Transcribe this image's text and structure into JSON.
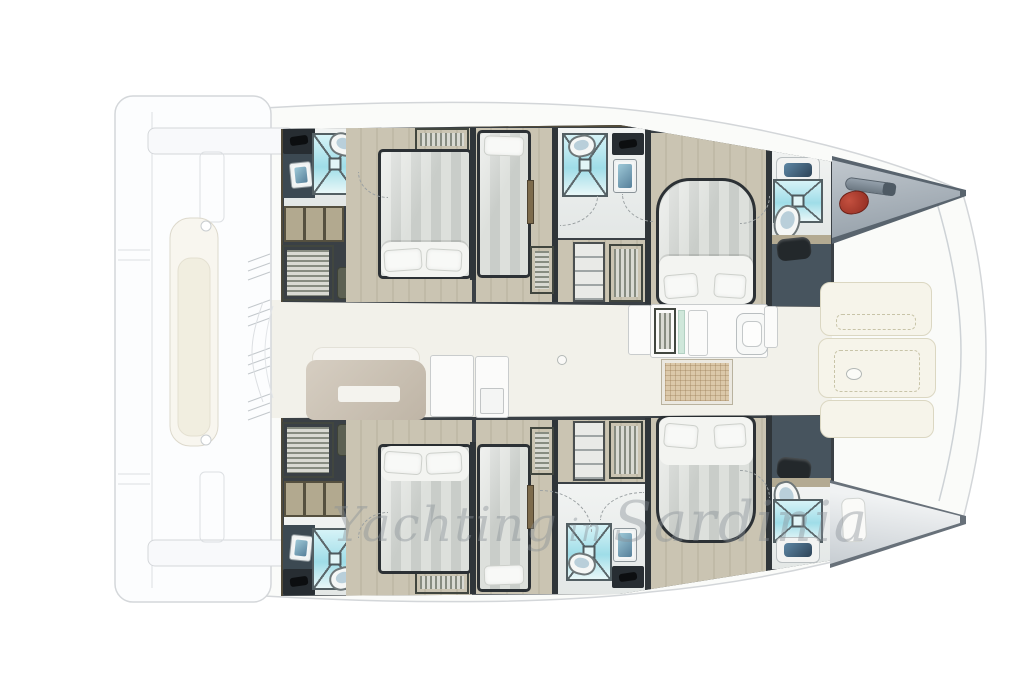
{
  "watermark": {
    "part1": "Yachting",
    "part2": "in",
    "part3": "Sardinia"
  },
  "palette": {
    "hull_wall": "#3a4045",
    "cabin_floor": "#c5bfad",
    "bathroom_floor": "#eceeec",
    "shower_teal": "#aee4ec",
    "bed_stripe": "#d4d7d3",
    "duvet_white": "#f3f4f1",
    "sofa_tan": "#cbc2b3",
    "sun_pad_cream": "#f6f4ea",
    "anchor_red": "#a93227",
    "locker_gray": "#9aa4ad",
    "ghost_deck_line": "#d4d7da"
  },
  "plan": {
    "vessel": "catamaran-floor-plan",
    "hull_top": {
      "fixtures": [
        {
          "t": "floor-bath",
          "x": 3,
          "y": 3,
          "w": 74,
          "h": 78
        },
        {
          "t": "vanity-dark",
          "x": 2,
          "y": 3,
          "w": 32,
          "h": 70
        },
        {
          "t": "counter-dark",
          "x": 2,
          "y": 3,
          "w": 32,
          "h": 26
        },
        {
          "t": "sink-blue",
          "x": 9,
          "y": 37,
          "w": 22,
          "h": 26,
          "r": -6
        },
        {
          "t": "shower",
          "x": 31,
          "y": 8,
          "w": 46,
          "h": 62
        },
        {
          "t": "toilet",
          "x": 48,
          "y": 8,
          "w": 29,
          "h": 23,
          "r": 18
        },
        {
          "t": "shelf-tan",
          "x": 3,
          "y": 81,
          "w": 60,
          "h": 36
        },
        {
          "t": "louver-h",
          "x": 1,
          "y": 120,
          "w": 52,
          "h": 56
        },
        {
          "t": "olive-box",
          "x": 56,
          "y": 142,
          "w": 40,
          "h": 32
        },
        {
          "t": "floor-cabin",
          "x": 65,
          "y": 3,
          "w": 126,
          "h": 174
        },
        {
          "t": "louver-v",
          "x": 134,
          "y": 3,
          "w": 54,
          "h": 23
        },
        {
          "t": "bed-double",
          "x": 97,
          "y": 24,
          "w": 94,
          "h": 130
        },
        {
          "t": "duvet",
          "x": 100,
          "y": 117,
          "w": 88,
          "h": 35
        },
        {
          "t": "pillow",
          "x": 103,
          "y": 124,
          "w": 38,
          "h": 22,
          "r": -4
        },
        {
          "t": "pillow",
          "x": 145,
          "y": 124,
          "w": 36,
          "h": 22,
          "r": 3
        },
        {
          "t": "wall",
          "x": 189,
          "y": 3,
          "w": 6,
          "h": 152
        },
        {
          "t": "floor-cabin",
          "x": 195,
          "y": 3,
          "w": 76,
          "h": 174
        },
        {
          "t": "bed-single",
          "x": 196,
          "y": 5,
          "w": 54,
          "h": 148
        },
        {
          "t": "pillow",
          "x": 203,
          "y": 11,
          "w": 40,
          "h": 20,
          "r": 2
        },
        {
          "t": "door-panel",
          "x": 246,
          "y": 55,
          "w": 7,
          "h": 44
        },
        {
          "t": "wall",
          "x": 271,
          "y": 3,
          "w": 6,
          "h": 174
        },
        {
          "t": "floor-bath",
          "x": 277,
          "y": 3,
          "w": 87,
          "h": 110
        },
        {
          "t": "shower",
          "x": 281,
          "y": 8,
          "w": 46,
          "h": 64
        },
        {
          "t": "toilet",
          "x": 287,
          "y": 10,
          "w": 28,
          "h": 22,
          "r": -12
        },
        {
          "t": "counter-dark",
          "x": 331,
          "y": 8,
          "w": 32,
          "h": 22
        },
        {
          "t": "sink-blue",
          "x": 332,
          "y": 34,
          "w": 24,
          "h": 34
        },
        {
          "t": "floor-cabin",
          "x": 277,
          "y": 115,
          "w": 87,
          "h": 62
        },
        {
          "t": "louver-h",
          "x": 249,
          "y": 121,
          "w": 24,
          "h": 48
        },
        {
          "t": "shelf-white",
          "x": 292,
          "y": 117,
          "w": 32,
          "h": 60
        },
        {
          "t": "louver-v",
          "x": 328,
          "y": 119,
          "w": 34,
          "h": 58
        },
        {
          "t": "wall",
          "x": 364,
          "y": 3,
          "w": 6,
          "h": 176
        },
        {
          "t": "floor-cabin",
          "x": 370,
          "y": 8,
          "w": 115,
          "h": 172
        },
        {
          "t": "bed-island-top",
          "x": 375,
          "y": 53,
          "w": 100,
          "h": 128
        },
        {
          "t": "duvet",
          "x": 378,
          "y": 131,
          "w": 94,
          "h": 48
        },
        {
          "t": "pillow",
          "x": 383,
          "y": 149,
          "w": 34,
          "h": 24,
          "r": -5
        },
        {
          "t": "pillow",
          "x": 433,
          "y": 149,
          "w": 32,
          "h": 24,
          "r": 4
        },
        {
          "t": "wall",
          "x": 485,
          "y": 3,
          "w": 6,
          "h": 178
        },
        {
          "t": "floor-bath",
          "x": 491,
          "y": 25,
          "w": 59,
          "h": 88
        },
        {
          "t": "counter-white",
          "x": 495,
          "y": 32,
          "w": 44,
          "h": 26
        },
        {
          "t": "shower",
          "x": 492,
          "y": 54,
          "w": 50,
          "h": 44
        },
        {
          "t": "toilet",
          "x": 493,
          "y": 80,
          "w": 26,
          "h": 34,
          "r": 15
        },
        {
          "t": "trim-tan",
          "x": 491,
          "y": 110,
          "w": 59,
          "h": 9
        },
        {
          "t": "slate",
          "x": 491,
          "y": 119,
          "w": 59,
          "h": 62
        },
        {
          "t": "bag",
          "x": 496,
          "y": 113,
          "w": 34,
          "h": 22,
          "r": -6
        }
      ]
    },
    "hull_bottom": {
      "fixtures": [
        {
          "t": "floor-bath",
          "x": 3,
          "y": 104,
          "w": 74,
          "h": 78
        },
        {
          "t": "vanity-dark",
          "x": 2,
          "y": 112,
          "w": 32,
          "h": 70
        },
        {
          "t": "counter-dark",
          "x": 2,
          "y": 156,
          "w": 32,
          "h": 26
        },
        {
          "t": "sink-blue",
          "x": 9,
          "y": 122,
          "w": 22,
          "h": 26,
          "r": 6
        },
        {
          "t": "shower",
          "x": 31,
          "y": 115,
          "w": 46,
          "h": 62
        },
        {
          "t": "toilet",
          "x": 48,
          "y": 154,
          "w": 29,
          "h": 23,
          "r": -18
        },
        {
          "t": "shelf-tan",
          "x": 3,
          "y": 68,
          "w": 60,
          "h": 36
        },
        {
          "t": "louver-h",
          "x": 1,
          "y": 9,
          "w": 52,
          "h": 56
        },
        {
          "t": "olive-box",
          "x": 56,
          "y": 11,
          "w": 40,
          "h": 32
        },
        {
          "t": "floor-cabin",
          "x": 65,
          "y": 7,
          "w": 126,
          "h": 176
        },
        {
          "t": "louver-v",
          "x": 134,
          "y": 158,
          "w": 54,
          "h": 23
        },
        {
          "t": "bed-double",
          "x": 97,
          "y": 31,
          "w": 94,
          "h": 130
        },
        {
          "t": "duvet",
          "x": 100,
          "y": 33,
          "w": 88,
          "h": 35
        },
        {
          "t": "pillow",
          "x": 103,
          "y": 39,
          "w": 38,
          "h": 22,
          "r": 4
        },
        {
          "t": "pillow",
          "x": 145,
          "y": 39,
          "w": 36,
          "h": 22,
          "r": -3
        },
        {
          "t": "wall",
          "x": 189,
          "y": 29,
          "w": 6,
          "h": 152
        },
        {
          "t": "floor-cabin",
          "x": 195,
          "y": 7,
          "w": 76,
          "h": 174
        },
        {
          "t": "bed-single",
          "x": 196,
          "y": 31,
          "w": 54,
          "h": 148
        },
        {
          "t": "pillow",
          "x": 203,
          "y": 152,
          "w": 40,
          "h": 20,
          "r": -2
        },
        {
          "t": "door-panel",
          "x": 246,
          "y": 72,
          "w": 7,
          "h": 44
        },
        {
          "t": "wall",
          "x": 271,
          "y": 7,
          "w": 6,
          "h": 174
        },
        {
          "t": "floor-bath",
          "x": 277,
          "y": 71,
          "w": 87,
          "h": 110
        },
        {
          "t": "shower",
          "x": 285,
          "y": 110,
          "w": 46,
          "h": 58
        },
        {
          "t": "toilet",
          "x": 287,
          "y": 140,
          "w": 28,
          "h": 22,
          "r": 12
        },
        {
          "t": "counter-dark",
          "x": 331,
          "y": 153,
          "w": 32,
          "h": 22
        },
        {
          "t": "sink-blue",
          "x": 332,
          "y": 115,
          "w": 24,
          "h": 34
        },
        {
          "t": "floor-cabin",
          "x": 277,
          "y": 7,
          "w": 87,
          "h": 62
        },
        {
          "t": "louver-h",
          "x": 249,
          "y": 14,
          "w": 24,
          "h": 48
        },
        {
          "t": "shelf-white",
          "x": 292,
          "y": 8,
          "w": 32,
          "h": 60
        },
        {
          "t": "louver-v",
          "x": 328,
          "y": 8,
          "w": 34,
          "h": 58
        },
        {
          "t": "wall",
          "x": 364,
          "y": 5,
          "w": 6,
          "h": 176
        },
        {
          "t": "floor-cabin",
          "x": 370,
          "y": 5,
          "w": 115,
          "h": 172
        },
        {
          "t": "bed-island-bottom",
          "x": 375,
          "y": 2,
          "w": 100,
          "h": 128
        },
        {
          "t": "duvet",
          "x": 378,
          "y": 4,
          "w": 94,
          "h": 48
        },
        {
          "t": "pillow",
          "x": 383,
          "y": 11,
          "w": 34,
          "h": 24,
          "r": 5
        },
        {
          "t": "pillow",
          "x": 433,
          "y": 11,
          "w": 32,
          "h": 24,
          "r": -4
        },
        {
          "t": "wall",
          "x": 485,
          "y": 2,
          "w": 6,
          "h": 178
        },
        {
          "t": "slate",
          "x": 491,
          "y": 3,
          "w": 59,
          "h": 62
        },
        {
          "t": "bag",
          "x": 496,
          "y": 45,
          "w": 34,
          "h": 22,
          "r": 6
        },
        {
          "t": "trim-tan",
          "x": 491,
          "y": 65,
          "w": 59,
          "h": 9
        },
        {
          "t": "floor-bath",
          "x": 491,
          "y": 74,
          "w": 59,
          "h": 82
        },
        {
          "t": "toilet",
          "x": 493,
          "y": 68,
          "w": 26,
          "h": 34,
          "r": -15
        },
        {
          "t": "shower",
          "x": 492,
          "y": 86,
          "w": 50,
          "h": 44
        },
        {
          "t": "counter-white",
          "x": 495,
          "y": 124,
          "w": 44,
          "h": 26
        }
      ]
    },
    "deck_fixtures": [
      {
        "t": "sofa-back",
        "x": 312,
        "y": 347,
        "w": 108,
        "h": 22
      },
      {
        "t": "sofa-body",
        "x": 306,
        "y": 360,
        "w": 120,
        "h": 60
      },
      {
        "t": "sofa-slot",
        "x": 338,
        "y": 386,
        "w": 62,
        "h": 16
      },
      {
        "t": "galley-unit",
        "x": 430,
        "y": 355,
        "w": 44,
        "h": 62
      },
      {
        "t": "galley-unit",
        "x": 475,
        "y": 356,
        "w": 34,
        "h": 62
      },
      {
        "t": "galley-sub",
        "x": 480,
        "y": 388,
        "w": 24,
        "h": 26
      },
      {
        "t": "deck-ring",
        "x": 557,
        "y": 355,
        "w": 10,
        "h": 10
      },
      {
        "t": "galley-unit",
        "x": 628,
        "y": 305,
        "w": 24,
        "h": 50
      },
      {
        "t": "galley-unit",
        "x": 650,
        "y": 304,
        "w": 118,
        "h": 54
      },
      {
        "t": "louver-v",
        "x": 654,
        "y": 308,
        "w": 22,
        "h": 46
      },
      {
        "t": "mint-strip",
        "x": 678,
        "y": 310,
        "w": 7,
        "h": 44
      },
      {
        "t": "galley-unit",
        "x": 688,
        "y": 310,
        "w": 20,
        "h": 46
      },
      {
        "t": "galley-sink",
        "x": 736,
        "y": 313,
        "w": 32,
        "h": 42
      },
      {
        "t": "galley-unit",
        "x": 764,
        "y": 306,
        "w": 14,
        "h": 42
      },
      {
        "t": "hatch-grid",
        "x": 662,
        "y": 360,
        "w": 70,
        "h": 44
      },
      {
        "t": "sun-pad",
        "x": 820,
        "y": 282,
        "w": 112,
        "h": 54
      },
      {
        "t": "pad-stitch",
        "x": 836,
        "y": 314,
        "w": 80,
        "h": 16,
        "z": 21
      },
      {
        "t": "sun-pad",
        "x": 818,
        "y": 338,
        "w": 118,
        "h": 60
      },
      {
        "t": "pad-stitch",
        "x": 834,
        "y": 350,
        "w": 86,
        "h": 42,
        "z": 21
      },
      {
        "t": "deck-ring",
        "x": 846,
        "y": 368,
        "w": 16,
        "h": 12,
        "z": 22
      },
      {
        "t": "sun-pad",
        "x": 820,
        "y": 400,
        "w": 114,
        "h": 38
      },
      {
        "t": "windlass",
        "x": 845,
        "y": 180,
        "w": 50,
        "h": 13,
        "r": 8
      },
      {
        "t": "anchor",
        "x": 839,
        "y": 191,
        "w": 30,
        "h": 23,
        "r": -12
      },
      {
        "t": "bow-cushion",
        "x": 842,
        "y": 498,
        "w": 24,
        "h": 44,
        "r": -3
      },
      {
        "t": "arc-bl",
        "x": 358,
        "y": 172,
        "w": 30,
        "h": 26
      },
      {
        "t": "arc-br",
        "x": 560,
        "y": 196,
        "w": 38,
        "h": 30
      },
      {
        "t": "arc-bl",
        "x": 622,
        "y": 194,
        "w": 32,
        "h": 28
      },
      {
        "t": "arc-br",
        "x": 740,
        "y": 196,
        "w": 30,
        "h": 28
      },
      {
        "t": "arc-tl",
        "x": 358,
        "y": 512,
        "w": 30,
        "h": 26
      },
      {
        "t": "arc-tr",
        "x": 540,
        "y": 490,
        "w": 52,
        "h": 42
      },
      {
        "t": "arc-tl",
        "x": 600,
        "y": 492,
        "w": 44,
        "h": 28
      },
      {
        "t": "arc-tr",
        "x": 740,
        "y": 470,
        "w": 30,
        "h": 28
      }
    ]
  }
}
